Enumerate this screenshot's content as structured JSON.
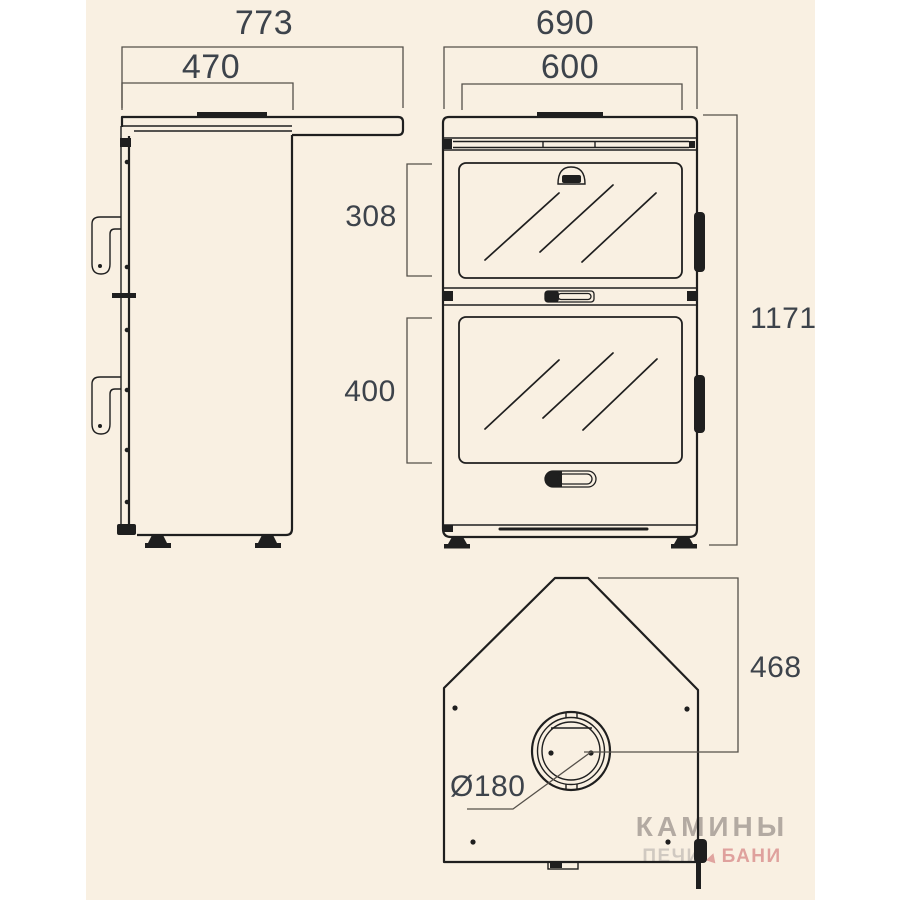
{
  "colors": {
    "page_bg": "#ffffff",
    "canvas_bg": "#f9f0e2",
    "object_line": "#1f1f1f",
    "dimension_line": "#55504a",
    "dimension_text": "#3d434b",
    "watermark_gray": "#b3aaa2",
    "watermark_light_gray": "#d0c9c1",
    "watermark_pink": "#dfa19d"
  },
  "side_view": {
    "dim_overall_depth": "773",
    "dim_body_depth": "470"
  },
  "front_view": {
    "dim_overall_width": "690",
    "dim_glass_width": "600",
    "dim_upper_door_height": "308",
    "dim_lower_door_height": "400",
    "dim_overall_height": "1171"
  },
  "top_view": {
    "dim_rear_to_flue": "468",
    "dim_flue_diameter": "Ø180"
  },
  "watermark": {
    "title": "КАМИНЫ",
    "subtitle_left": "ПЕЧИ",
    "subtitle_right": "БАНИ"
  }
}
